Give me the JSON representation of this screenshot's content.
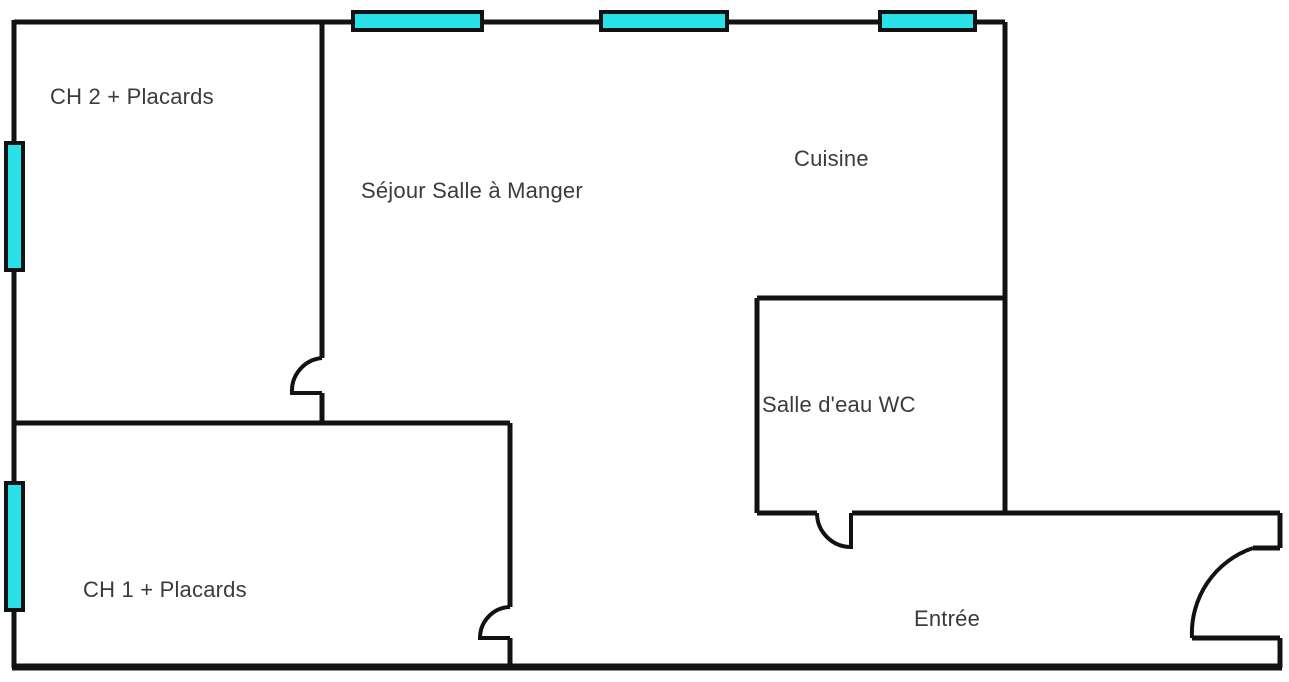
{
  "figure": {
    "type": "floor-plan",
    "description": "Apartment floor plan with two bedrooms, living-dining room, kitchen, shower room WC and entrance"
  },
  "colors": {
    "wall": "#121212",
    "window_fill": "#29E1E8",
    "label_text": "#3b3b3b",
    "background": "#ffffff"
  },
  "rooms": [
    {
      "name": "ch2",
      "label": "CH 2 + Placards"
    },
    {
      "name": "sejour",
      "label": "Séjour Salle à Manger"
    },
    {
      "name": "cuisine",
      "label": "Cuisine"
    },
    {
      "name": "salle_eau",
      "label": "Salle d'eau WC"
    },
    {
      "name": "ch1",
      "label": "CH 1 + Placards"
    },
    {
      "name": "entree",
      "label": "Entrée"
    }
  ],
  "features": {
    "windows": [
      "top-wall-window-sejour",
      "top-wall-window-sejour-cuisine",
      "top-wall-window-cuisine",
      "left-wall-window-ch2",
      "left-wall-window-ch1"
    ],
    "doors": [
      "door-swing-ch2",
      "door-swing-ch1",
      "door-swing-salle-eau",
      "door-swing-entree"
    ]
  }
}
